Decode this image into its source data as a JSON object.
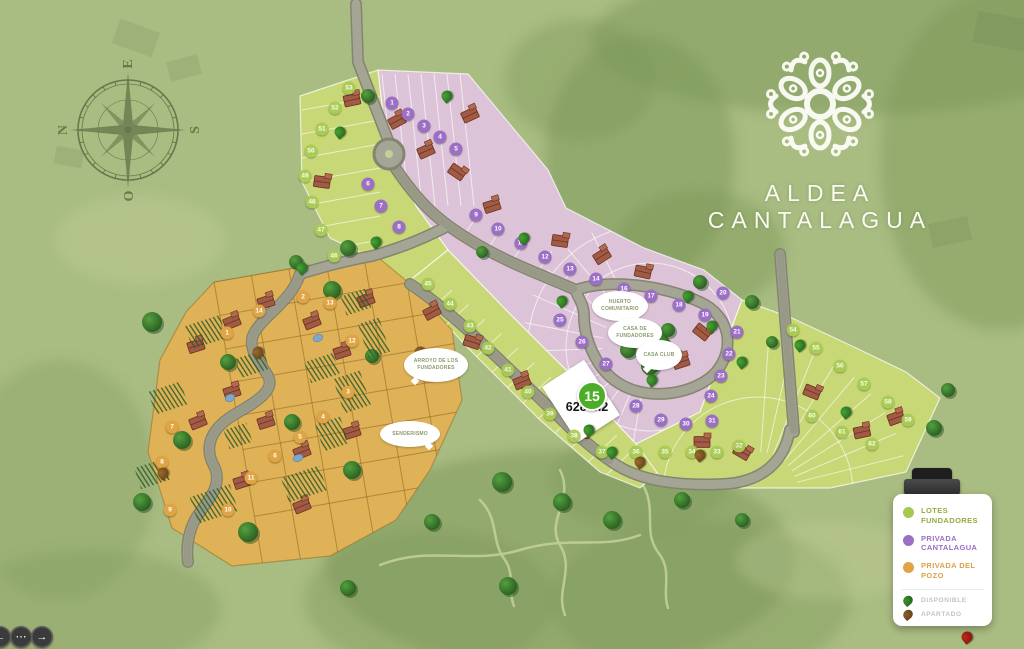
{
  "logo": {
    "title": "ALDEA CANTALAGUA"
  },
  "compass": {
    "n": "N",
    "e": "E",
    "s": "S",
    "o": "O"
  },
  "selected_lot": {
    "number": "15",
    "area": "628 m2"
  },
  "legend": {
    "zones": [
      {
        "id": "lotes_fundadores",
        "label": "LOTES FUNDADORES",
        "color": "#a8c94d"
      },
      {
        "id": "privada_cantalagua",
        "label": "PRIVADA CANTALAGUA",
        "color": "#9a6fc4"
      },
      {
        "id": "privada_del_pozo",
        "label": "PRIVADA DEL POZO",
        "color": "#dfa443"
      }
    ],
    "statuses": [
      {
        "id": "disponible",
        "label": "DISPONIBLE",
        "color": "#1d5c18"
      },
      {
        "id": "apartado",
        "label": "APARTADO",
        "color": "#5c3c12"
      }
    ]
  },
  "map": {
    "labels": [
      {
        "text": "ARROYO DE LOS FUNDADORES",
        "x": 404,
        "y": 348,
        "w": 60,
        "h": 30,
        "tail": "bl"
      },
      {
        "text": "SENDERISMO",
        "x": 380,
        "y": 421,
        "w": 56,
        "h": 22,
        "tail": "br"
      },
      {
        "text": "HUERTO COMUNITARIO",
        "x": 592,
        "y": 291,
        "w": 52,
        "h": 26,
        "tail": "br"
      },
      {
        "text": "CASA DE FUNDADORES",
        "x": 608,
        "y": 318,
        "w": 50,
        "h": 26,
        "tail": "br"
      },
      {
        "text": "CASA CLUB",
        "x": 636,
        "y": 340,
        "w": 42,
        "h": 26,
        "tail": "bl"
      }
    ],
    "markers": [
      {
        "n": "1",
        "x": 392,
        "y": 103,
        "zone": "privada_cantalagua"
      },
      {
        "n": "2",
        "x": 408,
        "y": 114,
        "zone": "privada_cantalagua"
      },
      {
        "n": "3",
        "x": 424,
        "y": 126,
        "zone": "privada_cantalagua"
      },
      {
        "n": "4",
        "x": 440,
        "y": 137,
        "zone": "privada_cantalagua"
      },
      {
        "n": "5",
        "x": 456,
        "y": 149,
        "zone": "privada_cantalagua"
      },
      {
        "n": "6",
        "x": 368,
        "y": 184,
        "zone": "privada_cantalagua"
      },
      {
        "n": "7",
        "x": 381,
        "y": 206,
        "zone": "privada_cantalagua"
      },
      {
        "n": "8",
        "x": 399,
        "y": 227,
        "zone": "privada_cantalagua"
      },
      {
        "n": "9",
        "x": 476,
        "y": 215,
        "zone": "privada_cantalagua"
      },
      {
        "n": "10",
        "x": 498,
        "y": 229,
        "zone": "privada_cantalagua"
      },
      {
        "n": "11",
        "x": 521,
        "y": 243,
        "zone": "privada_cantalagua"
      },
      {
        "n": "12",
        "x": 545,
        "y": 257,
        "zone": "privada_cantalagua"
      },
      {
        "n": "13",
        "x": 570,
        "y": 269,
        "zone": "privada_cantalagua"
      },
      {
        "n": "14",
        "x": 596,
        "y": 279,
        "zone": "privada_cantalagua"
      },
      {
        "n": "16",
        "x": 624,
        "y": 289,
        "zone": "privada_cantalagua"
      },
      {
        "n": "17",
        "x": 651,
        "y": 296,
        "zone": "privada_cantalagua"
      },
      {
        "n": "18",
        "x": 679,
        "y": 305,
        "zone": "privada_cantalagua"
      },
      {
        "n": "19",
        "x": 705,
        "y": 315,
        "zone": "privada_cantalagua"
      },
      {
        "n": "20",
        "x": 723,
        "y": 293,
        "zone": "privada_cantalagua"
      },
      {
        "n": "21",
        "x": 737,
        "y": 332,
        "zone": "privada_cantalagua"
      },
      {
        "n": "22",
        "x": 729,
        "y": 354,
        "zone": "privada_cantalagua"
      },
      {
        "n": "23",
        "x": 721,
        "y": 376,
        "zone": "privada_cantalagua"
      },
      {
        "n": "24",
        "x": 711,
        "y": 396,
        "zone": "privada_cantalagua"
      },
      {
        "n": "25",
        "x": 560,
        "y": 320,
        "zone": "privada_cantalagua"
      },
      {
        "n": "26",
        "x": 582,
        "y": 342,
        "zone": "privada_cantalagua"
      },
      {
        "n": "27",
        "x": 606,
        "y": 364,
        "zone": "privada_cantalagua"
      },
      {
        "n": "28",
        "x": 636,
        "y": 406,
        "zone": "privada_cantalagua"
      },
      {
        "n": "29",
        "x": 661,
        "y": 420,
        "zone": "privada_cantalagua"
      },
      {
        "n": "30",
        "x": 686,
        "y": 424,
        "zone": "privada_cantalagua"
      },
      {
        "n": "31",
        "x": 712,
        "y": 421,
        "zone": "privada_cantalagua"
      },
      {
        "n": "53",
        "x": 349,
        "y": 88,
        "zone": "lotes_fundadores"
      },
      {
        "n": "52",
        "x": 335,
        "y": 108,
        "zone": "lotes_fundadores"
      },
      {
        "n": "51",
        "x": 322,
        "y": 129,
        "zone": "lotes_fundadores"
      },
      {
        "n": "50",
        "x": 311,
        "y": 151,
        "zone": "lotes_fundadores"
      },
      {
        "n": "49",
        "x": 305,
        "y": 176,
        "zone": "lotes_fundadores"
      },
      {
        "n": "48",
        "x": 312,
        "y": 202,
        "zone": "lotes_fundadores"
      },
      {
        "n": "47",
        "x": 321,
        "y": 230,
        "zone": "lotes_fundadores"
      },
      {
        "n": "46",
        "x": 334,
        "y": 256,
        "zone": "lotes_fundadores"
      },
      {
        "n": "45",
        "x": 428,
        "y": 284,
        "zone": "lotes_fundadores"
      },
      {
        "n": "44",
        "x": 450,
        "y": 304,
        "zone": "lotes_fundadores"
      },
      {
        "n": "43",
        "x": 470,
        "y": 326,
        "zone": "lotes_fundadores"
      },
      {
        "n": "42",
        "x": 488,
        "y": 348,
        "zone": "lotes_fundadores"
      },
      {
        "n": "41",
        "x": 508,
        "y": 370,
        "zone": "lotes_fundadores"
      },
      {
        "n": "40",
        "x": 528,
        "y": 392,
        "zone": "lotes_fundadores"
      },
      {
        "n": "39",
        "x": 550,
        "y": 414,
        "zone": "lotes_fundadores"
      },
      {
        "n": "38",
        "x": 574,
        "y": 436,
        "zone": "lotes_fundadores"
      },
      {
        "n": "37",
        "x": 602,
        "y": 452,
        "zone": "lotes_fundadores"
      },
      {
        "n": "36",
        "x": 636,
        "y": 452,
        "zone": "lotes_fundadores"
      },
      {
        "n": "35",
        "x": 665,
        "y": 452,
        "zone": "lotes_fundadores"
      },
      {
        "n": "34",
        "x": 692,
        "y": 452,
        "zone": "lotes_fundadores"
      },
      {
        "n": "33",
        "x": 717,
        "y": 452,
        "zone": "lotes_fundadores"
      },
      {
        "n": "32",
        "x": 739,
        "y": 446,
        "zone": "lotes_fundadores"
      },
      {
        "n": "54",
        "x": 793,
        "y": 330,
        "zone": "lotes_fundadores"
      },
      {
        "n": "55",
        "x": 816,
        "y": 348,
        "zone": "lotes_fundadores"
      },
      {
        "n": "56",
        "x": 840,
        "y": 366,
        "zone": "lotes_fundadores"
      },
      {
        "n": "57",
        "x": 864,
        "y": 384,
        "zone": "lotes_fundadores"
      },
      {
        "n": "58",
        "x": 888,
        "y": 402,
        "zone": "lotes_fundadores"
      },
      {
        "n": "59",
        "x": 908,
        "y": 420,
        "zone": "lotes_fundadores"
      },
      {
        "n": "60",
        "x": 812,
        "y": 416,
        "zone": "lotes_fundadores"
      },
      {
        "n": "61",
        "x": 842,
        "y": 432,
        "zone": "lotes_fundadores"
      },
      {
        "n": "62",
        "x": 872,
        "y": 444,
        "zone": "lotes_fundadores"
      },
      {
        "n": "1",
        "x": 227,
        "y": 333,
        "zone": "privada_del_pozo"
      },
      {
        "n": "2",
        "x": 303,
        "y": 297,
        "zone": "privada_del_pozo"
      },
      {
        "n": "3",
        "x": 348,
        "y": 392,
        "zone": "privada_del_pozo"
      },
      {
        "n": "4",
        "x": 323,
        "y": 417,
        "zone": "privada_del_pozo"
      },
      {
        "n": "5",
        "x": 300,
        "y": 437,
        "zone": "privada_del_pozo"
      },
      {
        "n": "6",
        "x": 275,
        "y": 456,
        "zone": "privada_del_pozo"
      },
      {
        "n": "7",
        "x": 172,
        "y": 427,
        "zone": "privada_del_pozo"
      },
      {
        "n": "8",
        "x": 162,
        "y": 462,
        "zone": "privada_del_pozo"
      },
      {
        "n": "9",
        "x": 170,
        "y": 510,
        "zone": "privada_del_pozo"
      },
      {
        "n": "10",
        "x": 228,
        "y": 510,
        "zone": "privada_del_pozo"
      },
      {
        "n": "11",
        "x": 251,
        "y": 478,
        "zone": "privada_del_pozo"
      },
      {
        "n": "12",
        "x": 352,
        "y": 341,
        "zone": "privada_del_pozo"
      },
      {
        "n": "13",
        "x": 330,
        "y": 303,
        "zone": "privada_del_pozo"
      },
      {
        "n": "14",
        "x": 259,
        "y": 311,
        "zone": "privada_del_pozo"
      }
    ],
    "status_markers": [
      {
        "x": 447,
        "y": 96,
        "status": "disponible"
      },
      {
        "x": 340,
        "y": 132,
        "status": "disponible"
      },
      {
        "x": 376,
        "y": 242,
        "status": "disponible"
      },
      {
        "x": 524,
        "y": 238,
        "status": "disponible"
      },
      {
        "x": 562,
        "y": 301,
        "status": "disponible"
      },
      {
        "x": 612,
        "y": 452,
        "status": "disponible"
      },
      {
        "x": 688,
        "y": 296,
        "status": "disponible"
      },
      {
        "x": 712,
        "y": 326,
        "status": "disponible"
      },
      {
        "x": 742,
        "y": 362,
        "status": "disponible"
      },
      {
        "x": 800,
        "y": 345,
        "status": "disponible"
      },
      {
        "x": 846,
        "y": 412,
        "status": "disponible"
      },
      {
        "x": 302,
        "y": 268,
        "status": "disponible"
      },
      {
        "x": 589,
        "y": 430,
        "status": "disponible"
      },
      {
        "x": 652,
        "y": 380,
        "status": "disponible"
      },
      {
        "x": 420,
        "y": 352,
        "status": "apartado"
      },
      {
        "x": 640,
        "y": 462,
        "status": "apartado"
      },
      {
        "x": 258,
        "y": 352,
        "status": "apartado"
      },
      {
        "x": 163,
        "y": 473,
        "status": "apartado"
      },
      {
        "x": 700,
        "y": 455,
        "status": "apartado"
      },
      {
        "x": 967,
        "y": 637,
        "status": "rojo"
      }
    ]
  },
  "controls": {
    "prev": "←",
    "more": "⋯",
    "next": "→"
  }
}
